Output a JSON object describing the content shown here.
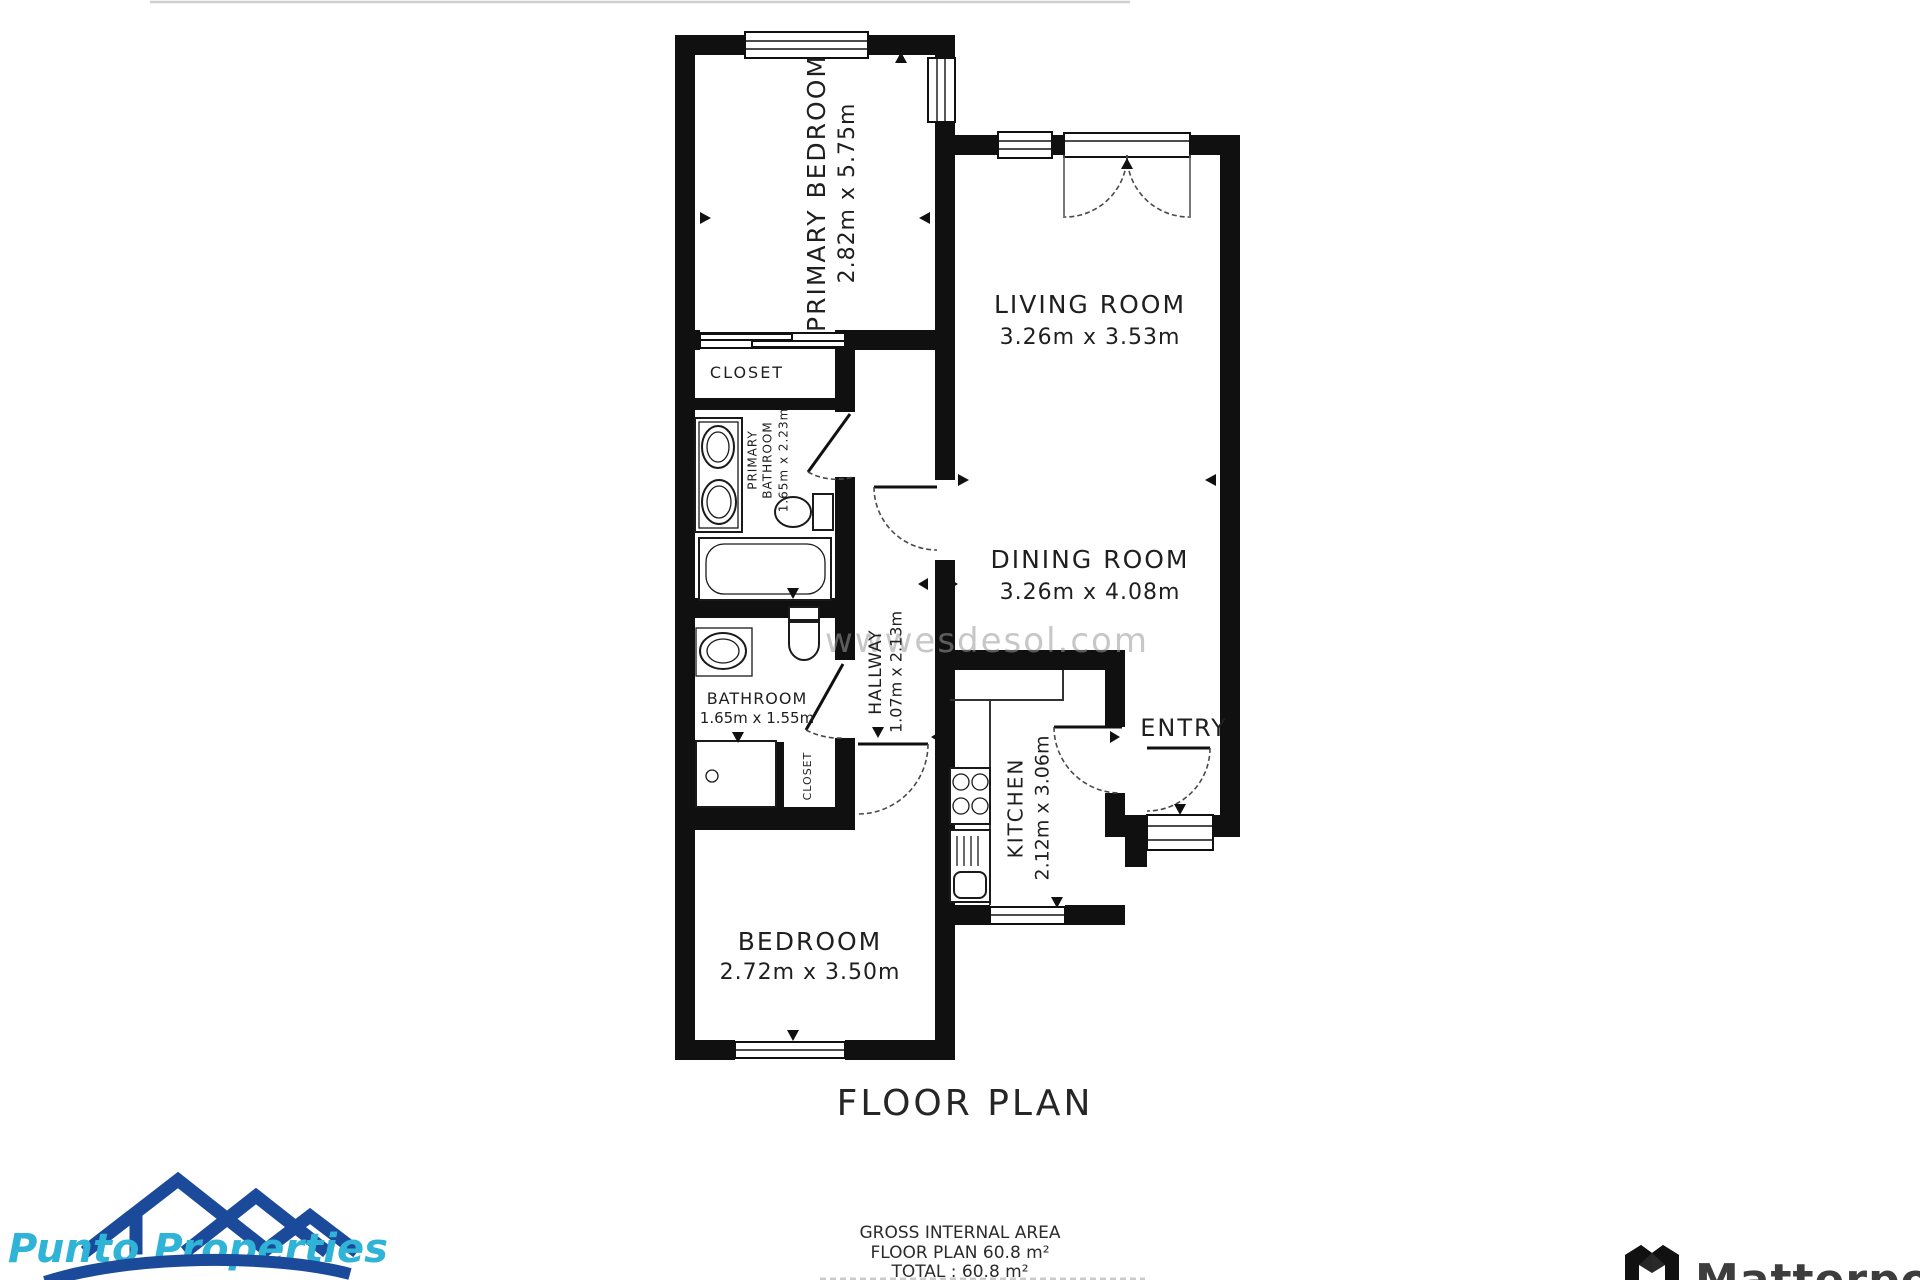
{
  "page": {
    "background": "#ffffff",
    "wall_ink": "#101010"
  },
  "title": {
    "text": "FLOOR PLAN"
  },
  "watermark": {
    "text": "wwwesdesol.com"
  },
  "rooms": {
    "primary_bedroom": {
      "name": "PRIMARY BEDROOM",
      "dims": "2.82m x 5.75m"
    },
    "closet_top": {
      "name": "CLOSET"
    },
    "primary_bathroom": {
      "name_line1": "PRIMARY",
      "name_line2": "BATHROOM",
      "dims": "1.65m x 2.23m"
    },
    "living_room": {
      "name": "LIVING ROOM",
      "dims": "3.26m x 3.53m"
    },
    "dining_room": {
      "name": "DINING ROOM",
      "dims": "3.26m x 4.08m"
    },
    "hallway": {
      "name": "HALLWAY",
      "dims": "1.07m x 2.13m"
    },
    "bathroom": {
      "name": "BATHROOM",
      "dims": "1.65m x 1.55m"
    },
    "closet_small": {
      "name": "CLOSET"
    },
    "kitchen": {
      "name": "KITCHEN",
      "dims": "2.12m x 3.06m"
    },
    "entry": {
      "name": "ENTRY"
    },
    "bedroom": {
      "name": "BEDROOM",
      "dims": "2.72m x 3.50m"
    }
  },
  "footer": {
    "line1": "GROSS INTERNAL AREA",
    "line2": "FLOOR PLAN 60.8 m²",
    "line3": "TOTAL :  60.8 m²"
  },
  "logos": {
    "punto": {
      "text": "Punto Properties",
      "roof_color": "#1b4a9a",
      "text_color": "#2fb3d6"
    },
    "matterport": {
      "text": "Matterport",
      "text_color": "#3d3d3d",
      "icon_gray": "#8a8a8a"
    }
  }
}
